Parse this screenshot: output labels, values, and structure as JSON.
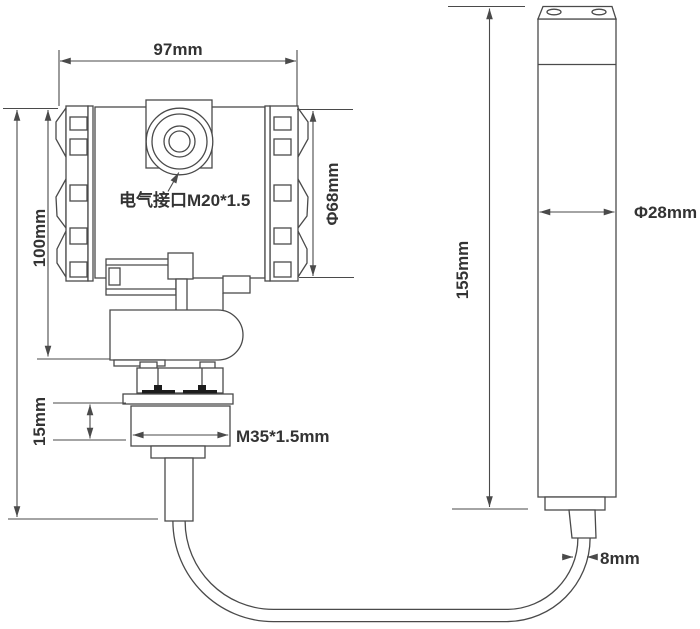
{
  "drawing": {
    "type": "technical-dimension-drawing",
    "labels": {
      "top_width": "97mm",
      "housing_height": "100mm",
      "housing_diameter": "Φ68mm",
      "electrical_interface": "电气接口M20*1.5",
      "thread_length": "15mm",
      "thread_spec": "M35*1.5mm",
      "probe_length": "155mm",
      "probe_diameter": "Φ28mm",
      "cable_diameter": "8mm"
    },
    "colors": {
      "background": "#ffffff",
      "line": "#4a4a4a",
      "text": "#333333",
      "solid_fill": "#1c1c1c"
    }
  }
}
